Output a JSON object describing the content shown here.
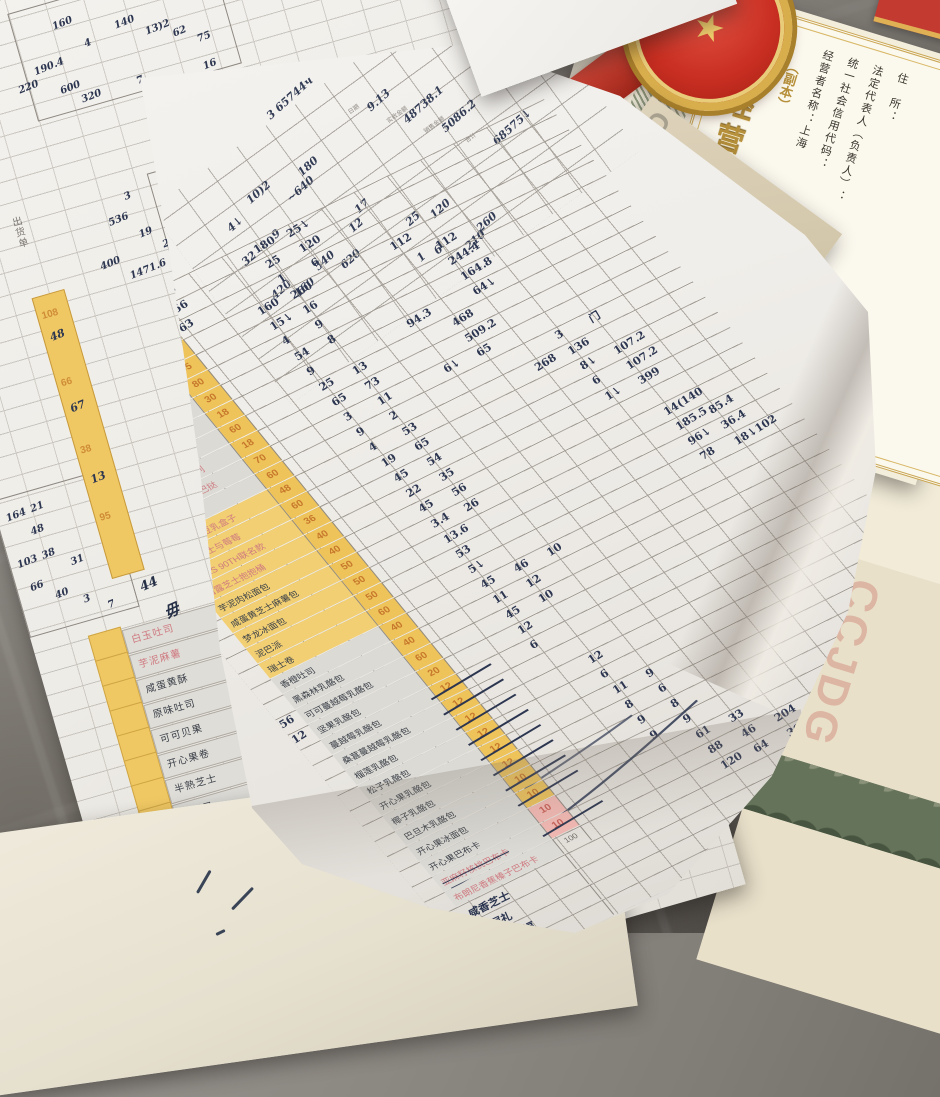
{
  "license": {
    "title": "食品经营许可证",
    "subtitle": "（副本）",
    "fields": [
      "经营者名称：上海",
      "统一社会信用代码：",
      "法定代表人（负责人）：",
      "住　所："
    ],
    "side_lines": [
      "公司吴中",
      "自然人投资",
      "（依法须经",
      "品销售，具体",
      "活动，"
    ],
    "watermark_letters": "CJDG",
    "corner_watermark": "CCJDG",
    "emblem_glyph": "★",
    "colors": {
      "gold": "#b6903a",
      "paper": "#fbf8ee",
      "emblem_red": "#c92f22"
    }
  },
  "main_sheet": {
    "top_note": "3 65744ч",
    "header": {
      "marks": [
        [
          218,
          36,
          "日期",
          "pr"
        ],
        [
          244,
          66,
          "实收金额",
          "pr"
        ],
        [
          268,
          96,
          "销售金额",
          "pr"
        ],
        [
          296,
          128,
          "合计",
          "pr"
        ],
        [
          236,
          40,
          "9.13"
        ],
        [
          258,
          70,
          "48738.1"
        ],
        [
          284,
          100,
          "5086.2"
        ],
        [
          318,
          140,
          "68575↓"
        ],
        [
          150,
          -14,
          "3 65744ч"
        ],
        [
          52,
          56,
          "4↓"
        ],
        [
          84,
          44,
          "10)2"
        ],
        [
          44,
          92,
          "32"
        ],
        [
          84,
          88,
          "9"
        ],
        [
          118,
          66,
          "~640"
        ],
        [
          142,
          52,
          "180"
        ],
        [
          48,
          136,
          "420"
        ],
        [
          68,
          148,
          "160"
        ],
        [
          100,
          138,
          "540"
        ],
        [
          122,
          152,
          "620"
        ],
        [
          150,
          128,
          "12"
        ],
        [
          166,
          116,
          "17"
        ],
        [
          200,
          156,
          "25"
        ],
        [
          224,
          164,
          "120"
        ],
        [
          188,
          192,
          "1"
        ],
        [
          206,
          196,
          "6"
        ],
        [
          234,
          210,
          "210"
        ],
        [
          254,
          202,
          "260"
        ]
      ]
    },
    "columns": {
      "name_header": "品名",
      "qty_color": "#eec35a"
    },
    "rows": [
      {
        "n": "黑钻坚果奶酪包",
        "b": "g",
        "q": "18",
        "hw": [
          [
            0,
            "108"
          ],
          [
            3,
            "180"
          ],
          [
            4,
            "25↓"
          ]
        ]
      },
      {
        "n": "脏脏大福团",
        "p": 1,
        "b": "g",
        "q": "210",
        "hw": [
          [
            0,
            "156"
          ],
          [
            3,
            "25"
          ],
          [
            4,
            "120"
          ]
        ]
      },
      {
        "n": "焙香紫米麻薯",
        "p": 1,
        "b": "g",
        "q": "105",
        "hw": [
          [
            0,
            "63"
          ],
          [
            3,
            "1"
          ],
          [
            4,
            "6"
          ]
        ]
      },
      {
        "n": "桑葚蛋糕",
        "b": "g",
        "q": "38",
        "hw": [
          [
            2,
            "160"
          ],
          [
            3,
            "260"
          ],
          [
            6,
            "112"
          ]
        ]
      },
      {
        "n": "芋泥肉松蛋糕",
        "p": 1,
        "b": "g",
        "q": "95",
        "hw": [
          [
            2,
            "15↓"
          ],
          [
            3,
            "16"
          ],
          [
            7,
            "112"
          ]
        ]
      },
      {
        "n": "黄天鹅布丁",
        "b": "g",
        "q": "80",
        "hw": [
          [
            2,
            "4"
          ],
          [
            3,
            "9"
          ],
          [
            7,
            "244.4"
          ]
        ]
      },
      {
        "n": "现烤芝士牛肉卷",
        "b": "g",
        "q": "30",
        "pre": "337",
        "hw": [
          [
            2,
            "54"
          ],
          [
            3,
            "8"
          ],
          [
            7,
            "164.8"
          ]
        ]
      },
      {
        "n": "开心花环",
        "b": "g",
        "q": "18",
        "pre": "乃",
        "hw": [
          [
            2,
            "9"
          ],
          [
            5,
            "94.3"
          ],
          [
            7,
            "64↓"
          ]
        ]
      },
      {
        "n": "巧克力乔巴挞",
        "b": "g",
        "q": "60",
        "hw": [
          [
            2,
            "25"
          ],
          [
            3,
            "13"
          ],
          [
            6,
            "468"
          ]
        ]
      },
      {
        "n": "焦糖雷神PLUS系列",
        "p": 1,
        "b": "g",
        "q": "18",
        "pre": "52",
        "hw": [
          [
            2,
            "65"
          ],
          [
            3,
            "73"
          ],
          [
            6,
            "509.2"
          ]
        ]
      },
      {
        "n": "牛奶糖PLUS乔巴挞",
        "p": 1,
        "b": "g",
        "q": "70",
        "hw": [
          [
            2,
            "3"
          ],
          [
            3,
            "11"
          ],
          [
            5,
            "6↓"
          ],
          [
            6,
            "65"
          ]
        ]
      },
      {
        "n": "生乳吐司",
        "b": "g",
        "q": "60",
        "hw": [
          [
            2,
            "9"
          ],
          [
            3,
            "2"
          ],
          [
            8,
            "3"
          ],
          [
            9,
            "门"
          ]
        ]
      },
      {
        "n": "雪媚娘与豆乳盒子",
        "p": 1,
        "b": "y",
        "q": "48",
        "hw": [
          [
            2,
            "4"
          ],
          [
            3,
            "53"
          ],
          [
            7,
            "268"
          ],
          [
            8,
            "136"
          ]
        ]
      },
      {
        "n": "开心芝士与莓莓",
        "p": 1,
        "b": "y",
        "q": "60",
        "hw": [
          [
            2,
            "19"
          ],
          [
            3,
            "65"
          ],
          [
            8,
            "8↓"
          ],
          [
            9,
            "107.2"
          ]
        ]
      },
      {
        "n": "PHKS 90TH联名款",
        "p": 1,
        "b": "y",
        "q": "36",
        "hw": [
          [
            2,
            "45"
          ],
          [
            3,
            "54"
          ],
          [
            8,
            "6"
          ],
          [
            9,
            "107.2"
          ]
        ]
      },
      {
        "n": "白露芝士抱抱桶",
        "p": 1,
        "b": "y",
        "q": "40",
        "hw": [
          [
            2,
            "22"
          ],
          [
            3,
            "35"
          ],
          [
            8,
            "1↓"
          ],
          [
            9,
            "399"
          ]
        ]
      },
      {
        "n": "芋泥肉松面包",
        "b": "y",
        "q": "40",
        "hw": [
          [
            2,
            "45"
          ],
          [
            3,
            "56"
          ]
        ]
      },
      {
        "n": "咸蛋黄芝士麻薯包",
        "b": "y",
        "q": "50",
        "hw": [
          [
            2,
            "3.4"
          ],
          [
            3,
            "26"
          ],
          [
            9,
            "14(140"
          ]
        ]
      },
      {
        "n": "梦龙冰面包",
        "b": "y",
        "q": "50",
        "hw": [
          [
            2,
            "13.6"
          ],
          [
            9,
            "185.5"
          ],
          [
            10,
            "85.4"
          ]
        ]
      },
      {
        "n": "泥巴派",
        "b": "y",
        "q": "50",
        "hw": [
          [
            2,
            "53"
          ],
          [
            9,
            "96↓"
          ],
          [
            10,
            "36.4"
          ]
        ]
      },
      {
        "n": "瑞士卷",
        "b": "y",
        "q": "60",
        "hw": [
          [
            2,
            "5↓"
          ],
          [
            9,
            "78"
          ],
          [
            10,
            "18↓102"
          ]
        ]
      },
      {
        "n": "香橙吐司",
        "b": "g",
        "q": "40",
        "hw": [
          [
            2,
            "45"
          ],
          [
            3,
            "46"
          ],
          [
            4,
            "10"
          ]
        ]
      },
      {
        "n": "黑森林乳酪包",
        "b": "g",
        "q": "40",
        "hw": [
          [
            2,
            "11"
          ],
          [
            3,
            "12"
          ]
        ]
      },
      {
        "n": "可可蔓越莓乳酪包",
        "b": "g",
        "q": "60",
        "pre": "56",
        "hw": [
          [
            2,
            "45"
          ],
          [
            3,
            "10"
          ]
        ]
      },
      {
        "n": "坚果乳酪包",
        "b": "g",
        "q": "20",
        "pre": "12",
        "hw": [
          [
            2,
            "12"
          ]
        ]
      },
      {
        "n": "蔓越莓乳酪包",
        "b": "g",
        "q": "12",
        "s": 1,
        "hw": [
          [
            2,
            "6"
          ]
        ]
      },
      {
        "n": "桑葚蔓越莓乳酪包",
        "b": "g",
        "q": "12",
        "s": 1
      },
      {
        "n": "榴莲乳酪包",
        "b": "g",
        "q": "12",
        "s": 1,
        "hw": [
          [
            3,
            "12"
          ]
        ]
      },
      {
        "n": "松子乳酪包",
        "b": "g",
        "q": "12",
        "s": 1,
        "hw": [
          [
            3,
            "6"
          ]
        ]
      },
      {
        "n": "开心果乳酪包",
        "b": "g",
        "q": "12",
        "s": 1,
        "hw": [
          [
            3,
            "11"
          ],
          [
            4,
            "9"
          ]
        ]
      },
      {
        "n": "椰子乳酪包",
        "b": "g",
        "q": "12",
        "s": 1,
        "hw": [
          [
            3,
            "8"
          ],
          [
            4,
            "6"
          ]
        ]
      },
      {
        "n": "巴旦木乳酪包",
        "b": "g",
        "q": "10",
        "s": 1,
        "hw": [
          [
            3,
            "9"
          ],
          [
            4,
            "8"
          ]
        ]
      },
      {
        "n": "开心果冰面包",
        "b": "g",
        "q": "10",
        "s": 1,
        "hw": [
          [
            3,
            "9"
          ],
          [
            4,
            "9"
          ]
        ]
      },
      {
        "n": "开心果巴布卡",
        "b": "g",
        "q": "10",
        "k": "p",
        "hw": [
          [
            4,
            "61"
          ],
          [
            5,
            "33"
          ]
        ]
      },
      {
        "n": "亚麻籽核桃巴布卡",
        "p": 1,
        "b": "g",
        "q": "10",
        "k": "p",
        "s": 1,
        "hw": [
          [
            4,
            "88"
          ],
          [
            5,
            "46"
          ],
          [
            6,
            "204"
          ]
        ]
      },
      {
        "n": "布朗尼香蕉榛子巴布卡",
        "p": 1,
        "b": "g",
        "q": "100",
        "k": "w",
        "hw": [
          [
            4,
            "120"
          ],
          [
            5,
            "64"
          ],
          [
            6,
            "300"
          ],
          [
            7,
            "278"
          ],
          [
            8,
            "160"
          ]
        ]
      },
      {
        "n": "咸香芝士",
        "t": "hw"
      },
      {
        "n": "千层礼",
        "t": "hw"
      },
      {
        "n": "芋泥大福",
        "t": "hw"
      },
      {
        "n": "雪胖子",
        "t": "hw"
      }
    ]
  },
  "left_sheet": {
    "label": "出货单",
    "marks": [
      [
        190,
        140,
        "160"
      ],
      [
        216,
        166,
        "4"
      ],
      [
        160,
        178,
        "190.4"
      ],
      [
        140,
        192,
        "220"
      ],
      [
        180,
        204,
        "600"
      ],
      [
        198,
        218,
        "320"
      ],
      [
        250,
        156,
        "140"
      ],
      [
        278,
        170,
        "13)2"
      ],
      [
        304,
        180,
        "62"
      ],
      [
        326,
        192,
        "75"
      ],
      [
        292,
        136,
        "16"
      ],
      [
        322,
        146,
        "4"
      ],
      [
        256,
        216,
        "7"
      ],
      [
        278,
        226,
        "2"
      ],
      [
        300,
        236,
        "3"
      ],
      [
        324,
        220,
        "16"
      ],
      [
        300,
        268,
        "43835.5"
      ],
      [
        254,
        330,
        "80.4"
      ],
      [
        276,
        346,
        "380"
      ],
      [
        298,
        362,
        "787.3"
      ],
      [
        190,
        344,
        "536"
      ],
      [
        212,
        324,
        "3"
      ],
      [
        216,
        364,
        "19"
      ],
      [
        236,
        380,
        "24"
      ],
      [
        170,
        384,
        "400"
      ],
      [
        196,
        400,
        "1471.6"
      ],
      [
        30,
        620,
        "48"
      ],
      [
        36,
        598,
        "21"
      ],
      [
        34,
        646,
        "38"
      ],
      [
        60,
        660,
        "31"
      ],
      [
        8,
        648,
        "103"
      ],
      [
        14,
        674,
        "66"
      ],
      [
        36,
        688,
        "40"
      ],
      [
        62,
        700,
        "3"
      ],
      [
        84,
        712,
        "7"
      ],
      [
        10,
        600,
        "164"
      ],
      [
        95,
        317,
        "出货单",
        "pr-v"
      ]
    ],
    "boxes": [
      [
        150,
        120,
        210,
        110
      ],
      [
        262,
        250,
        120,
        38
      ],
      [
        240,
        312,
        150,
        100
      ],
      [
        0,
        584,
        112,
        140
      ]
    ],
    "yellow_col_values": [
      "108",
      "66",
      "38",
      "95"
    ],
    "yellow_col_hand": [
      "48",
      "67",
      "13"
    ],
    "names": [
      {
        "n": "白玉吐司",
        "p": 1
      },
      {
        "n": "芋泥麻薯",
        "p": 1
      },
      {
        "n": "咸蛋黄酥"
      },
      {
        "n": "原味吐司"
      },
      {
        "n": "可可贝果"
      },
      {
        "n": "开心果卷"
      },
      {
        "n": "半熟芝士"
      },
      {
        "n": "布朗尼"
      }
    ],
    "big_chars": [
      {
        "t": "44",
        "x": 120,
        "y": 700,
        "fs": 13
      },
      {
        "t": "毋",
        "x": 136,
        "y": 728,
        "fs": 15
      },
      {
        "t": "咸",
        "x": 208,
        "y": 862,
        "fs": 16
      },
      {
        "t": "全家",
        "x": 222,
        "y": 898,
        "fs": 17
      },
      {
        "t": "盎乃",
        "x": 236,
        "y": 938,
        "fs": 16
      }
    ]
  },
  "cream_paper": {
    "marks_note": "pen ticks"
  }
}
